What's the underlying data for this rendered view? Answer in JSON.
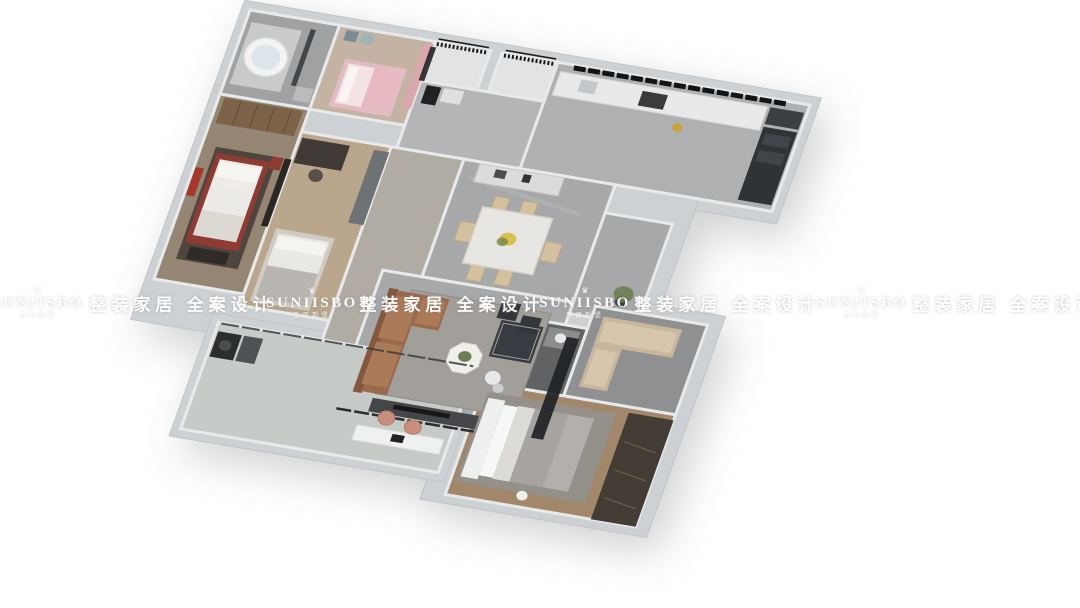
{
  "watermark": {
    "crown_icon": "♛",
    "brand": "SUNIISBO",
    "brand_sub": "圣尼斯堡",
    "slogan": "整装家居 全案设计",
    "sequence": [
      "logo",
      "slogan",
      "logo",
      "slogan",
      "logo",
      "slogan",
      "logo",
      "slogan"
    ]
  },
  "scene": {
    "description": "3D bird's-eye render of a furnished three-bedroom apartment floor plan",
    "background": "#ffffff",
    "rooms": [
      "bathroom",
      "kids-bedroom",
      "north-balcony",
      "foyer",
      "kitchen",
      "master-bedroom",
      "study-bedroom",
      "hallway",
      "dining-room",
      "living-room",
      "passage",
      "laundry-balcony",
      "ensuite-bathroom",
      "cloak-room",
      "guest-bedroom"
    ],
    "colors": {
      "wall": "#ced1d3",
      "wall_edge": "#c2c5c7",
      "wall_cap": "#e7e9ea",
      "floor_marble": "#a7a8aa",
      "marble_vein": "#c9cacb",
      "floor_tile": "#9fa1a3",
      "floor_tile_dark": "#606264",
      "floor_wood_master": "#948672",
      "floor_wood_study": "#b9a68d",
      "floor_wood_guest": "#a2876a",
      "floor_kids": "#c4b3a2",
      "floor_balcony": "#c7cbc8",
      "floor_open": "#e2e3e4",
      "floor_foyer": "#b3b5b7",
      "floor_kitchen": "#aeb0b2",
      "floor_hall": "#b0aba3",
      "floor_cloak": "#8e9092",
      "leather_sofa": "#9a6a4e",
      "leather_light": "#ab7a58",
      "sofa_back": "#84573e",
      "bed_red": "#8e3b34",
      "art_red": "#a5372b",
      "pink_frame": "#e3bcc2",
      "pink_light": "#f2e3e4",
      "pink_blanket": "#e7b9c0",
      "curtain_pink": "#dca6ad",
      "chair_beige": "#d2c09e",
      "chair_beige_edge": "#bfa988",
      "tan_sofa": "#c9b69d",
      "tan_light": "#d7c6ae",
      "gold_pan": "#c9a23a",
      "plant_green": "#6d7d52",
      "plant_dark": "#5f7246",
      "leaf_green": "#7a8a4a",
      "flower_yellow": "#d8c050",
      "duvet_gray": "#a6a3a0",
      "rug_gray": "#a29e99",
      "rug_guest": "#93908c",
      "rug_dark": "#463f39",
      "cabinet_gray": "#6f7275",
      "wardrobe_wood": "#7c6249",
      "wardrobe_stripe": "#5f4a35",
      "wardrobe_dark": "#433d36",
      "wardrobe_dark_stripe": "#6b5a46",
      "dark_glass": "#202225",
      "dark_furniture": "#35363a",
      "tv_console": "#45464a",
      "tv_black": "#17181a",
      "fridge": "#303336",
      "counter_white": "#e8e9ea",
      "sideboard": "#dadbdc",
      "blanket_gray": "#b9b6b1",
      "table_top": "#e8e6e2",
      "mattress_white": "#eceae6",
      "pillow_white": "#f7f5f2",
      "shower_dark": "#33363a",
      "vanity_gray": "#8b8d8f",
      "chair_rose": "#c98f7e",
      "desk_white": "#eff0f0",
      "laptop_dark": "#202224",
      "railing_black": "#17181a",
      "window_black": "#121314",
      "tub_white": "#f2f3f3",
      "tub_water": "#dde6ea",
      "headboard_white": "#eef0f0"
    }
  }
}
